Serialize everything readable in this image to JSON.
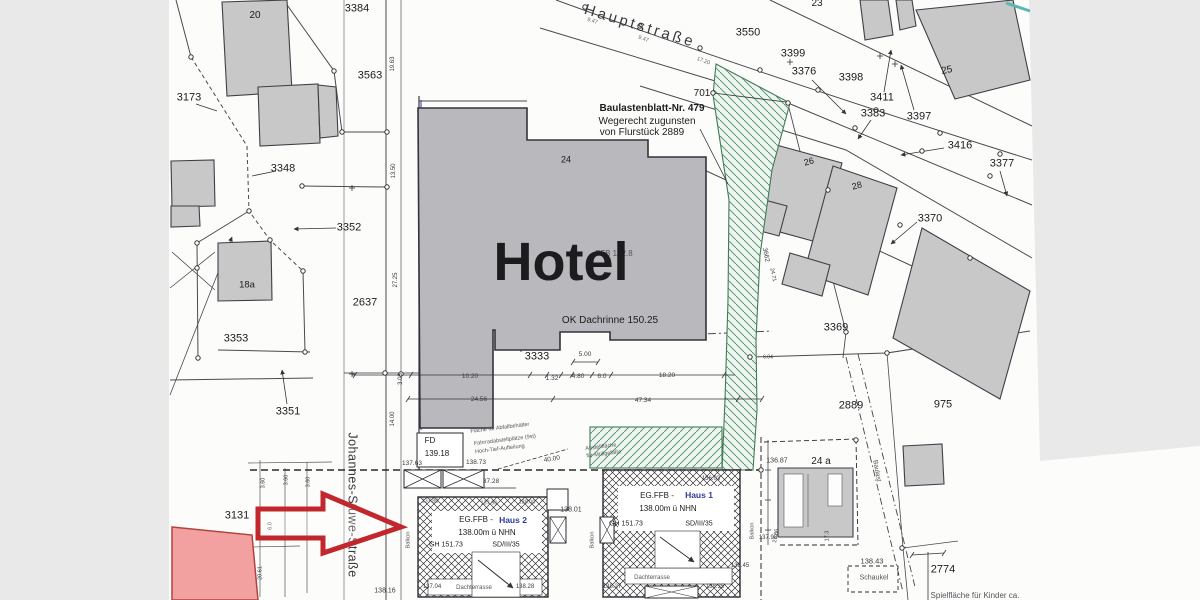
{
  "palette": {
    "margin_gray": "#e9e9e9",
    "paper_white": "#fcfcfb",
    "building_gray": "#c8c8c9",
    "hotel_gray": "#b9b9bd",
    "outline_dark": "#3f3f46",
    "green_hatch": "#3f7a54",
    "teal_accent": "#59b8b2",
    "annotation_red": "#c1272d",
    "highlight_pink": "#f2a0a0",
    "blue_text": "#2c3c9c"
  },
  "map_labels": [
    {
      "n": "street-name-hauptstrasse",
      "t": "Hauptstraße",
      "x": 640,
      "y": 26,
      "fs": 15,
      "r": 17,
      "ls": 3,
      "c": "#3a3a3e"
    },
    {
      "n": "street-name-johannes-stuwe-strasse",
      "t": "Johannes-Stuwe-Straße",
      "x": 352,
      "y": 505,
      "fs": 12.5,
      "r": 90,
      "ls": 0.5,
      "c": "#3a3a3e"
    },
    {
      "n": "parcel-20",
      "t": "20",
      "x": 255,
      "y": 16,
      "fs": 10
    },
    {
      "n": "parcel-3384",
      "t": "3384",
      "x": 357,
      "y": 9,
      "fs": 11
    },
    {
      "n": "parcel-3563",
      "t": "3563",
      "x": 370,
      "y": 76,
      "fs": 11
    },
    {
      "n": "parcel-3173",
      "t": "3173",
      "x": 189,
      "y": 98,
      "fs": 11
    },
    {
      "n": "parcel-3348",
      "t": "3348",
      "x": 283,
      "y": 169,
      "fs": 11
    },
    {
      "n": "parcel-3352",
      "t": "3352",
      "x": 349,
      "y": 228,
      "fs": 11
    },
    {
      "n": "parcel-2637",
      "t": "2637",
      "x": 365,
      "y": 303,
      "fs": 11
    },
    {
      "n": "parcel-3353",
      "t": "3353",
      "x": 236,
      "y": 339,
      "fs": 11
    },
    {
      "n": "parcel-3351",
      "t": "3351",
      "x": 288,
      "y": 412,
      "fs": 11
    },
    {
      "n": "parcel-18a",
      "t": "18a",
      "x": 247,
      "y": 285,
      "fs": 9.5
    },
    {
      "n": "parcel-3131",
      "t": "3131",
      "x": 237,
      "y": 516,
      "fs": 11
    },
    {
      "n": "parcel-3550",
      "t": "3550",
      "x": 748,
      "y": 33,
      "fs": 11
    },
    {
      "n": "parcel-3399",
      "t": "3399",
      "x": 793,
      "y": 54,
      "fs": 11
    },
    {
      "n": "parcel-3376",
      "t": "3376",
      "x": 804,
      "y": 72,
      "fs": 11
    },
    {
      "n": "parcel-3398",
      "t": "3398",
      "x": 851,
      "y": 78,
      "fs": 11
    },
    {
      "n": "parcel-23",
      "t": "23",
      "x": 817,
      "y": 4,
      "fs": 10
    },
    {
      "n": "parcel-701",
      "t": "701",
      "x": 702,
      "y": 94,
      "fs": 10
    },
    {
      "n": "parcel-3411",
      "t": "3411",
      "x": 882,
      "y": 98,
      "fs": 11
    },
    {
      "n": "parcel-3383",
      "t": "3383",
      "x": 873,
      "y": 114,
      "fs": 11
    },
    {
      "n": "parcel-3397",
      "t": "3397",
      "x": 919,
      "y": 117,
      "fs": 11
    },
    {
      "n": "parcel-3416",
      "t": "3416",
      "x": 960,
      "y": 146,
      "fs": 11
    },
    {
      "n": "parcel-3377",
      "t": "3377",
      "x": 1002,
      "y": 164,
      "fs": 11
    },
    {
      "n": "building-25",
      "t": "25",
      "x": 947,
      "y": 71,
      "fs": 10,
      "r": -12
    },
    {
      "n": "building-26",
      "t": "26",
      "x": 809,
      "y": 162,
      "fs": 9,
      "r": -15
    },
    {
      "n": "building-28",
      "t": "28",
      "x": 857,
      "y": 186,
      "fs": 9,
      "r": -15
    },
    {
      "n": "parcel-3370",
      "t": "3370",
      "x": 930,
      "y": 219,
      "fs": 11
    },
    {
      "n": "parcel-3369",
      "t": "3369",
      "x": 836,
      "y": 328,
      "fs": 11
    },
    {
      "n": "parcel-2889",
      "t": "2889",
      "x": 851,
      "y": 406,
      "fs": 11
    },
    {
      "n": "parcel-975",
      "t": "975",
      "x": 943,
      "y": 405,
      "fs": 11
    },
    {
      "n": "parcel-24a",
      "t": "24 a",
      "x": 821,
      "y": 462,
      "fs": 10
    },
    {
      "n": "parcel-2774",
      "t": "2774",
      "x": 943,
      "y": 570,
      "fs": 11
    },
    {
      "n": "parcel-24",
      "t": "24",
      "x": 566,
      "y": 160,
      "fs": 9
    },
    {
      "n": "parcel-3333",
      "t": "3333",
      "x": 537,
      "y": 357,
      "fs": 11
    },
    {
      "n": "note-line-1",
      "t": "Baulastenblatt-Nr. 479",
      "x": 652,
      "y": 109,
      "fs": 10,
      "b": true
    },
    {
      "n": "note-line-2",
      "t": "Wegerecht zugunsten",
      "x": 647,
      "y": 122,
      "fs": 10
    },
    {
      "n": "note-line-3",
      "t": "von Flurstück 2889",
      "x": 642,
      "y": 133,
      "fs": 10
    },
    {
      "n": "hotel-ffb-elevation",
      "t": "FFB 142.8",
      "x": 614,
      "y": 254,
      "fs": 8,
      "c": "#55555a"
    },
    {
      "n": "hotel-label",
      "t": "Hotel",
      "x": 561,
      "y": 262,
      "fs": 54,
      "b": true
    },
    {
      "n": "hotel-gutter-elevation",
      "t": "OK Dachrinne 150.25",
      "x": 610,
      "y": 321,
      "fs": 10
    },
    {
      "n": "dim-9-47-a",
      "t": "9.47",
      "x": 592,
      "y": 22,
      "fs": 5.5,
      "r": 18,
      "c": "#66666a"
    },
    {
      "n": "dim-9-47-b",
      "t": "9.47",
      "x": 643,
      "y": 40,
      "fs": 5.5,
      "r": 19,
      "c": "#66666a"
    },
    {
      "n": "dim-17-20",
      "t": "17.20",
      "x": 703,
      "y": 62,
      "fs": 5.5,
      "r": 20,
      "c": "#66666a"
    },
    {
      "n": "dim-19-63",
      "t": "19.63",
      "x": 393,
      "y": 64,
      "fs": 6,
      "r": -90,
      "c": "#3c3c40"
    },
    {
      "n": "dim-13-50",
      "t": "13.50",
      "x": 394,
      "y": 171,
      "fs": 6,
      "r": -90,
      "c": "#3c3c40"
    },
    {
      "n": "dim-27-25",
      "t": "27.25",
      "x": 396,
      "y": 280,
      "fs": 6,
      "r": -90,
      "c": "#3c3c40"
    },
    {
      "n": "dim-3-03",
      "t": "3.03",
      "x": 401,
      "y": 379,
      "fs": 6,
      "r": -90,
      "c": "#3c3c40"
    },
    {
      "n": "dim-14-00",
      "t": "14.00",
      "x": 393,
      "y": 419,
      "fs": 6,
      "r": -90,
      "c": "#3c3c40"
    },
    {
      "n": "dim-10-20",
      "t": "10.20",
      "x": 470,
      "y": 377,
      "fs": 6.5,
      "c": "#3c3c40"
    },
    {
      "n": "dim-1-32",
      "t": "1.32",
      "x": 552,
      "y": 379,
      "fs": 6.5,
      "c": "#3c3c40"
    },
    {
      "n": "dim-4-80",
      "t": "4.80",
      "x": 578,
      "y": 377,
      "fs": 6.5,
      "c": "#3c3c40"
    },
    {
      "n": "dim-5-00",
      "t": "5.00",
      "x": 585,
      "y": 355,
      "fs": 6.5,
      "c": "#3c3c40"
    },
    {
      "n": "dim-6-0",
      "t": "6.0",
      "x": 602,
      "y": 377,
      "fs": 6.5,
      "c": "#3c3c40"
    },
    {
      "n": "dim-18-20",
      "t": "18.20",
      "x": 667,
      "y": 376,
      "fs": 6.5,
      "c": "#3c3c40"
    },
    {
      "n": "dim-24-56",
      "t": "24.56",
      "x": 479,
      "y": 400,
      "fs": 6.5,
      "c": "#3c3c40"
    },
    {
      "n": "dim-47-34",
      "t": "47.34",
      "x": 643,
      "y": 401,
      "fs": 6.5,
      "c": "#3c3c40"
    },
    {
      "n": "dim-3-60-a",
      "t": "3.60",
      "x": 264,
      "y": 483,
      "fs": 5.5,
      "r": -90,
      "c": "#3c3c40"
    },
    {
      "n": "dim-3-60-b",
      "t": "3.60",
      "x": 287,
      "y": 480,
      "fs": 5.5,
      "r": -90,
      "c": "#3c3c40"
    },
    {
      "n": "dim-3-60-c",
      "t": "3.60",
      "x": 309,
      "y": 482,
      "fs": 5.5,
      "r": -90,
      "c": "#3c3c40"
    },
    {
      "n": "dim-6-0-b",
      "t": "6.0",
      "x": 271,
      "y": 526,
      "fs": 5.5,
      "r": -90,
      "c": "#3c3c40"
    },
    {
      "n": "dim-20-61",
      "t": "20.61",
      "x": 261,
      "y": 573,
      "fs": 5.5,
      "r": -90,
      "c": "#3c3c40"
    },
    {
      "n": "parcel-3662",
      "t": "3662",
      "x": 765,
      "y": 255,
      "fs": 6.5,
      "r": 78,
      "c": "#3c3c40"
    },
    {
      "n": "dim-24-71",
      "t": "24.71",
      "x": 772,
      "y": 275,
      "fs": 5.5,
      "r": 78,
      "c": "#3c3c40"
    },
    {
      "n": "dim-6-04",
      "t": "6.04",
      "x": 768,
      "y": 358,
      "fs": 5,
      "c": "#3c3c40"
    },
    {
      "n": "dim-27-86",
      "t": "27.86",
      "x": 777,
      "y": 536,
      "fs": 5.5,
      "r": -80,
      "c": "#3c3c40"
    },
    {
      "n": "dim-17-3",
      "t": "17.3",
      "x": 828,
      "y": 536,
      "fs": 5.5,
      "r": -90,
      "c": "#3c3c40"
    },
    {
      "n": "fd-label",
      "t": "FD",
      "x": 430,
      "y": 441,
      "fs": 8
    },
    {
      "n": "fd-elevation",
      "t": "139.18",
      "x": 437,
      "y": 454,
      "fs": 8
    },
    {
      "n": "elev-137-63",
      "t": "137.63",
      "x": 412,
      "y": 464,
      "fs": 6.5,
      "c": "#3c3c40"
    },
    {
      "n": "elev-138-73",
      "t": "138.73",
      "x": 476,
      "y": 463,
      "fs": 6.5,
      "c": "#3c3c40"
    },
    {
      "n": "dim-40-00",
      "t": "40.00",
      "x": 552,
      "y": 460,
      "fs": 6.5,
      "r": -9,
      "c": "#3c3c40"
    },
    {
      "n": "dim-37-28",
      "t": "37.28",
      "x": 491,
      "y": 482,
      "fs": 6.5,
      "c": "#3c3c40"
    },
    {
      "n": "elev-138-01",
      "t": "138.01",
      "x": 571,
      "y": 510,
      "fs": 7,
      "c": "#3c3c40"
    },
    {
      "n": "elev-136-87",
      "t": "136.87",
      "x": 777,
      "y": 461,
      "fs": 7,
      "c": "#3c3c40"
    },
    {
      "n": "elev-136-03",
      "t": "136.03",
      "x": 711,
      "y": 479,
      "fs": 6,
      "c": "#3c3c40"
    },
    {
      "n": "elev-137-98",
      "t": "137.98",
      "x": 768,
      "y": 538,
      "fs": 6,
      "c": "#3c3c40"
    },
    {
      "n": "elev-138-45",
      "t": "138.45",
      "x": 740,
      "y": 566,
      "fs": 6,
      "c": "#3c3c40"
    },
    {
      "n": "elev-138-35",
      "t": "138.35",
      "x": 715,
      "y": 587,
      "fs": 6,
      "c": "#3c3c40"
    },
    {
      "n": "elev-138-27",
      "t": "138.27",
      "x": 612,
      "y": 587,
      "fs": 6,
      "c": "#3c3c40"
    },
    {
      "n": "elev-137-04",
      "t": "137.04",
      "x": 432,
      "y": 587,
      "fs": 6,
      "c": "#3c3c40"
    },
    {
      "n": "elev-138-28",
      "t": "138.28",
      "x": 525,
      "y": 587,
      "fs": 6,
      "c": "#3c3c40"
    },
    {
      "n": "elev-138-16",
      "t": "138.16",
      "x": 385,
      "y": 591,
      "fs": 7,
      "c": "#3c3c40"
    },
    {
      "n": "elev-138-43",
      "t": "138.43",
      "x": 872,
      "y": 561,
      "fs": 7.5,
      "c": "#3c3c40"
    },
    {
      "n": "elev-137-80",
      "t": "137.80",
      "x": 430,
      "y": 502,
      "fs": 5.5,
      "c": "#55555a"
    },
    {
      "n": "elev-137-90",
      "t": "137.90",
      "x": 489,
      "y": 504,
      "fs": 5.5,
      "c": "#55555a"
    },
    {
      "n": "elev-138-00",
      "t": "138.00",
      "x": 527,
      "y": 503,
      "fs": 5.5,
      "c": "#55555a"
    },
    {
      "n": "house2-egffb",
      "t": "EG.FFB -",
      "x": 476,
      "y": 520,
      "fs": 8
    },
    {
      "n": "house2-name",
      "t": "Haus 2",
      "x": 513,
      "y": 520,
      "fs": 8.5,
      "b": true,
      "c": "#2c3c9c"
    },
    {
      "n": "house2-elevation",
      "t": "138.00m ü NHN",
      "x": 487,
      "y": 533,
      "fs": 8
    },
    {
      "n": "house2-gh",
      "t": "GH 151.73",
      "x": 446,
      "y": 545,
      "fs": 7
    },
    {
      "n": "house2-roof",
      "t": "SD/III/35",
      "x": 506,
      "y": 545,
      "fs": 7
    },
    {
      "n": "house2-terrace",
      "t": "Dachterrasse",
      "x": 474,
      "y": 588,
      "fs": 6,
      "c": "#55555a"
    },
    {
      "n": "house1-egffb",
      "t": "EG.FFB -",
      "x": 657,
      "y": 496,
      "fs": 8
    },
    {
      "n": "house1-name",
      "t": "Haus 1",
      "x": 699,
      "y": 495,
      "fs": 8.5,
      "b": true,
      "c": "#2c3c9c"
    },
    {
      "n": "house1-elevation",
      "t": "138.00m ü NHN",
      "x": 668,
      "y": 509,
      "fs": 8
    },
    {
      "n": "house1-gh",
      "t": "GH 151.73",
      "x": 626,
      "y": 524,
      "fs": 7
    },
    {
      "n": "house1-roof",
      "t": "SD/III/35",
      "x": 699,
      "y": 524,
      "fs": 7
    },
    {
      "n": "house1-terrace",
      "t": "Dachterrasse",
      "x": 652,
      "y": 578,
      "fs": 6,
      "c": "#55555a"
    },
    {
      "n": "balkon-left",
      "t": "Balkon",
      "x": 409,
      "y": 540,
      "fs": 5.5,
      "r": -90,
      "c": "#55555a"
    },
    {
      "n": "balkon-mid",
      "t": "Balkon",
      "x": 593,
      "y": 540,
      "fs": 5.5,
      "r": -90,
      "c": "#55555a"
    },
    {
      "n": "balkon-right",
      "t": "Balkon",
      "x": 753,
      "y": 531,
      "fs": 5.5,
      "r": -90,
      "c": "#55555a"
    },
    {
      "n": "baulast-path-label",
      "t": "Baulast",
      "x": 876,
      "y": 471,
      "fs": 6.5,
      "r": 79,
      "c": "#55555a"
    },
    {
      "n": "schaukel-label",
      "t": "Schaukel",
      "x": 874,
      "y": 578,
      "fs": 7,
      "c": "#55555a"
    },
    {
      "n": "playground-label",
      "t": "Spielfläche für Kinder ca.",
      "x": 975,
      "y": 596,
      "fs": 8,
      "c": "#55555a"
    },
    {
      "n": "waste-area-note",
      "t": "Fläche für Abfallbehälter",
      "x": 500,
      "y": 429,
      "fs": 5.5,
      "r": -7,
      "c": "#55555a"
    },
    {
      "n": "bike-parking-note",
      "t": "Fahrradabstellplätze (9st)",
      "x": 505,
      "y": 441,
      "fs": 5.5,
      "r": -7,
      "c": "#55555a"
    },
    {
      "n": "hoch-tief-note",
      "t": "Hoch-Tief-Aufteilung",
      "x": 500,
      "y": 450,
      "fs": 5.5,
      "r": -7,
      "c": "#55555a"
    },
    {
      "n": "bin-area-note-1",
      "t": "Abstellfläche",
      "x": 601,
      "y": 448,
      "fs": 5.5,
      "r": -7,
      "c": "#55555a"
    },
    {
      "n": "bin-area-note-2",
      "t": "für Müllgefäße",
      "x": 604,
      "y": 455,
      "fs": 5.5,
      "r": -7,
      "c": "#55555a"
    }
  ]
}
